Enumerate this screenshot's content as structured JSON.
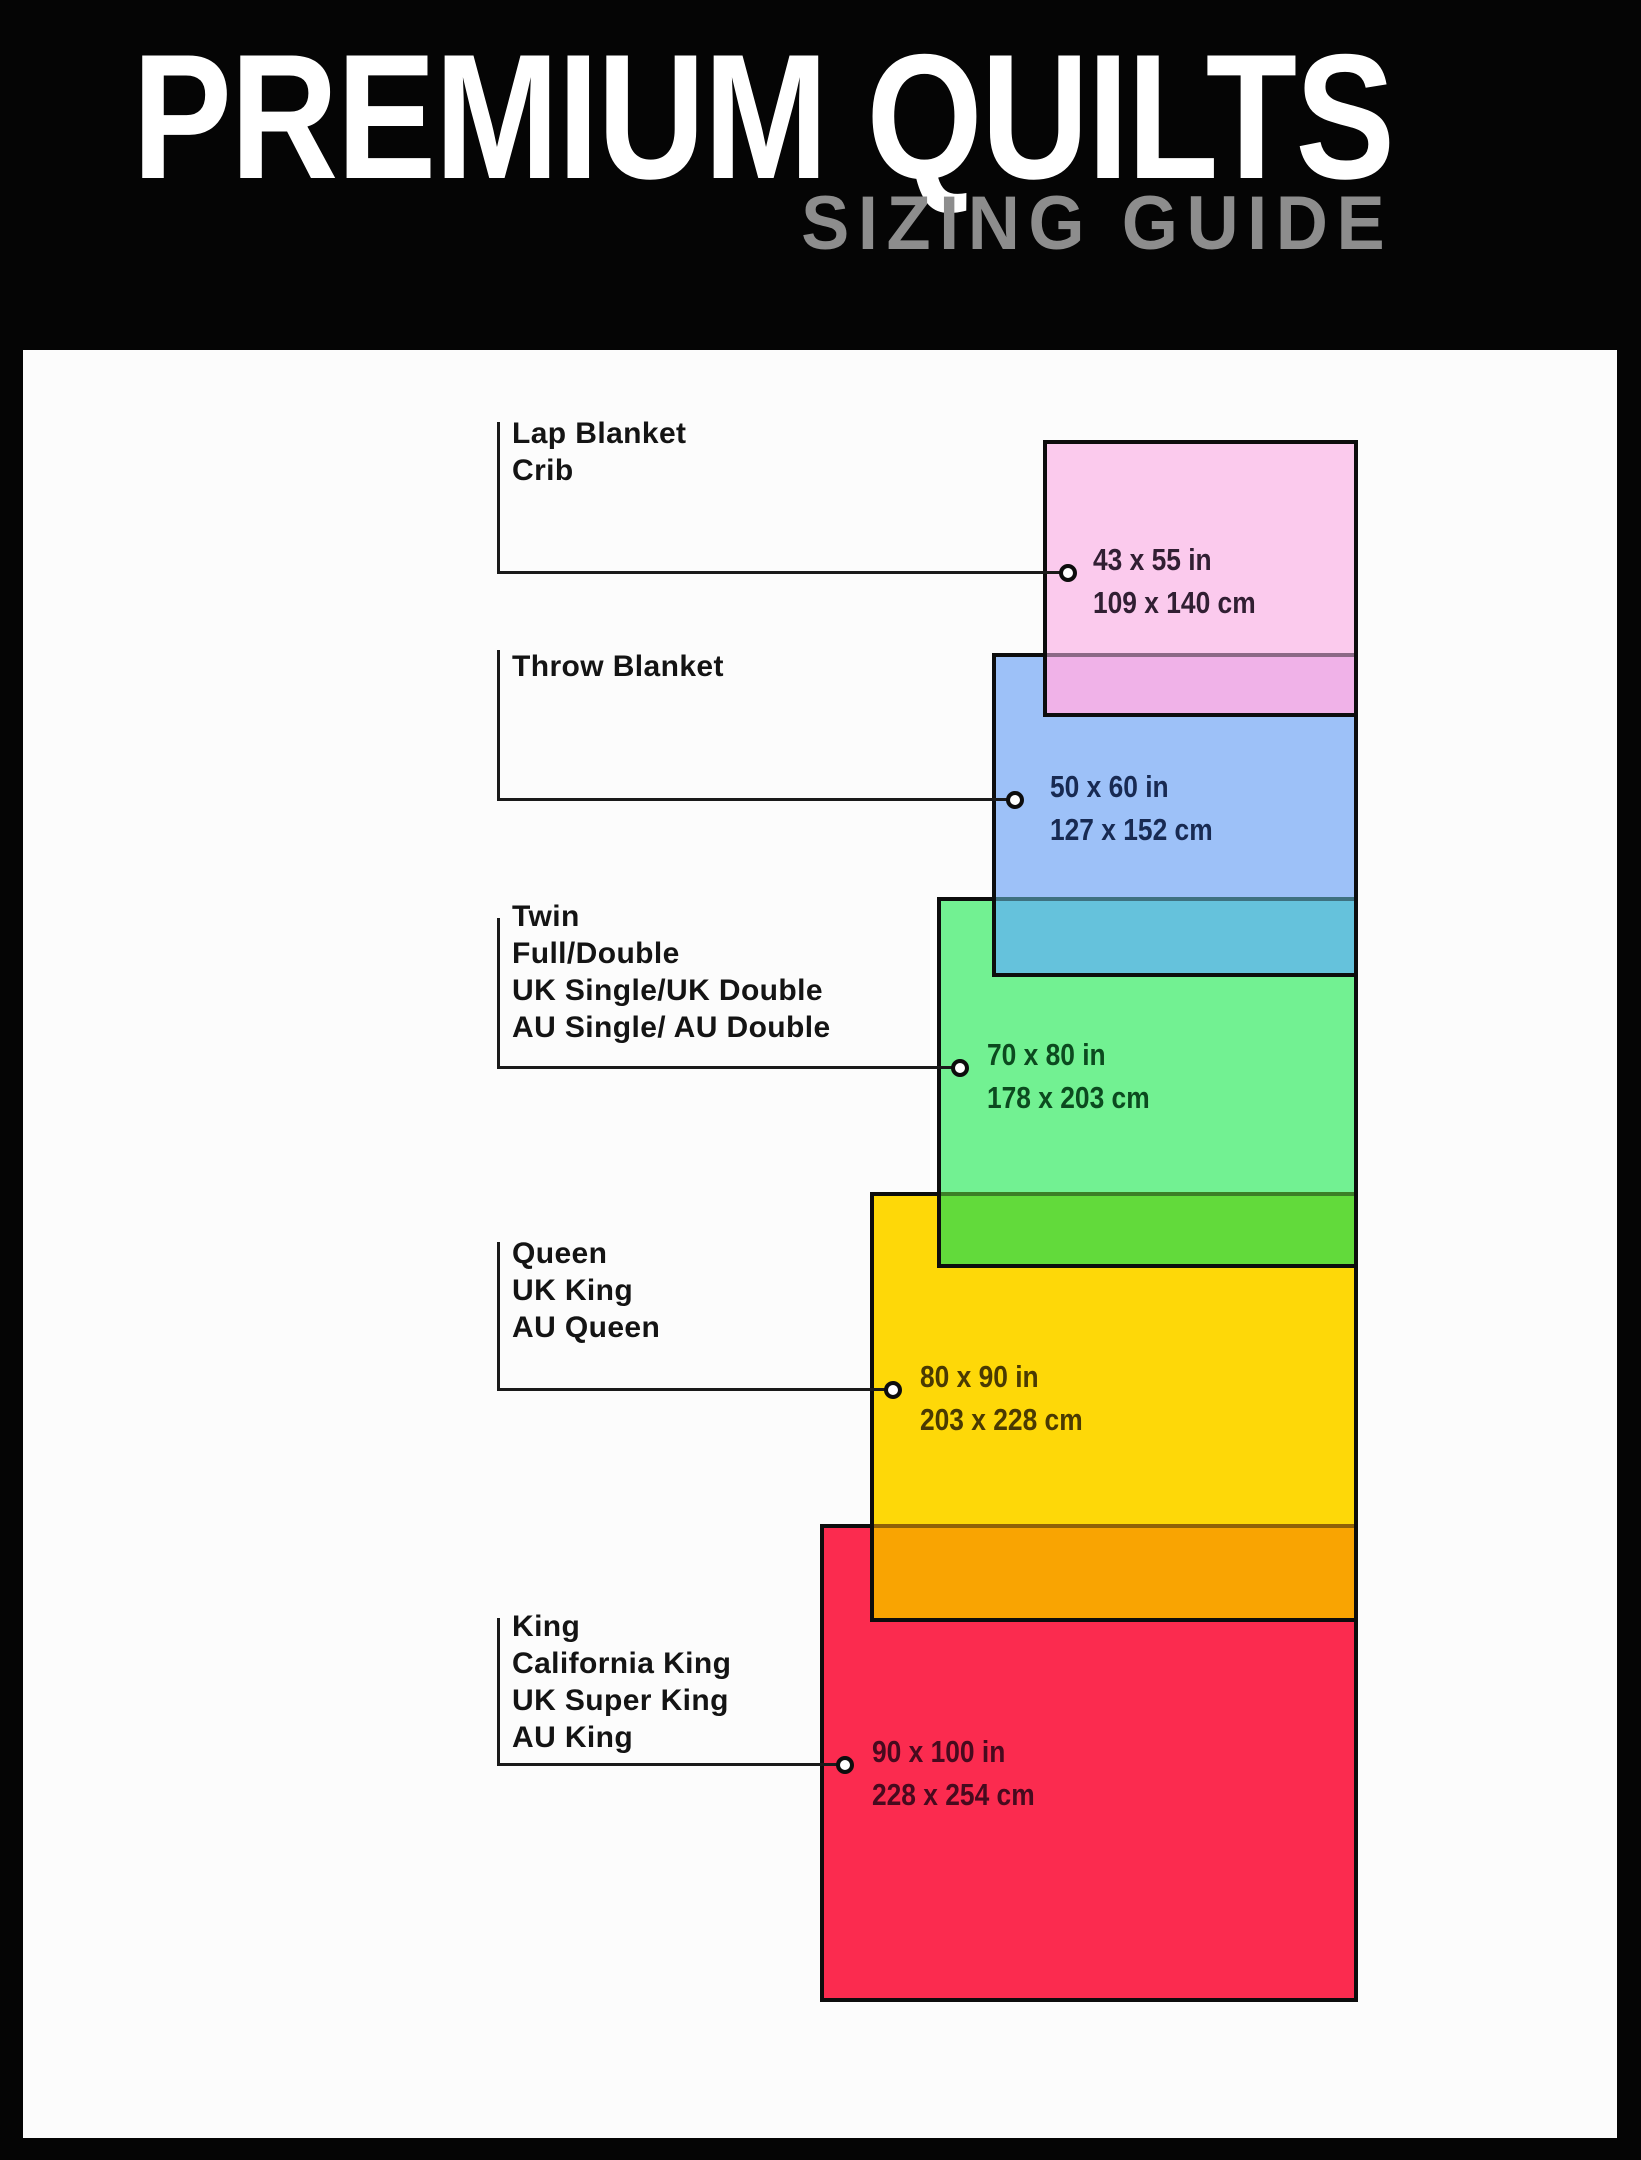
{
  "header": {
    "title": "PREMIUM QUILTS",
    "subtitle": "SIZING GUIDE",
    "title_color": "#ffffff",
    "subtitle_color": "#8d8d8d",
    "background": "#050505"
  },
  "canvas": {
    "background": "#fcfcfc",
    "rect_border_color": "#0d0d0d",
    "connector_color": "#1a1a1a"
  },
  "sizes": [
    {
      "names": [
        "Lap Blanket",
        "Crib"
      ],
      "inches": "43 x 55 in",
      "centimeters": "109 x 140 cm",
      "fill": "#FBCAED",
      "value_text_color": "#311F33"
    },
    {
      "names": [
        "Throw Blanket"
      ],
      "inches": "50 x 60 in",
      "centimeters": "127 x 152 cm",
      "fill": "#9DC1F8",
      "value_text_color": "#182A52"
    },
    {
      "names": [
        "Twin",
        "Full/Double",
        "UK Single/UK Double",
        "AU Single/ AU Double"
      ],
      "inches": "70 x 80 in",
      "centimeters": "178 x 203 cm",
      "fill": "#72F192",
      "value_text_color": "#0C4A1F"
    },
    {
      "names": [
        "Queen",
        "UK King",
        "AU Queen"
      ],
      "inches": "80 x 90 in",
      "centimeters": "203 x 228 cm",
      "fill": "#FED808",
      "value_text_color": "#4A3A02"
    },
    {
      "names": [
        "King",
        "California King",
        "UK Super King",
        "AU King"
      ],
      "inches": "90 x 100 in",
      "centimeters": "228 x 254 cm",
      "fill": "#FB2B4F",
      "value_text_color": "#470A1E"
    }
  ],
  "overlaps": [
    {
      "between": "lap-over-throw",
      "fill": "#F0B2E8"
    },
    {
      "between": "throw-over-twin",
      "fill": "#65C2DC"
    },
    {
      "between": "twin-over-queen",
      "fill": "#62DA3B"
    },
    {
      "between": "queen-over-king",
      "fill": "#F9A402"
    }
  ]
}
